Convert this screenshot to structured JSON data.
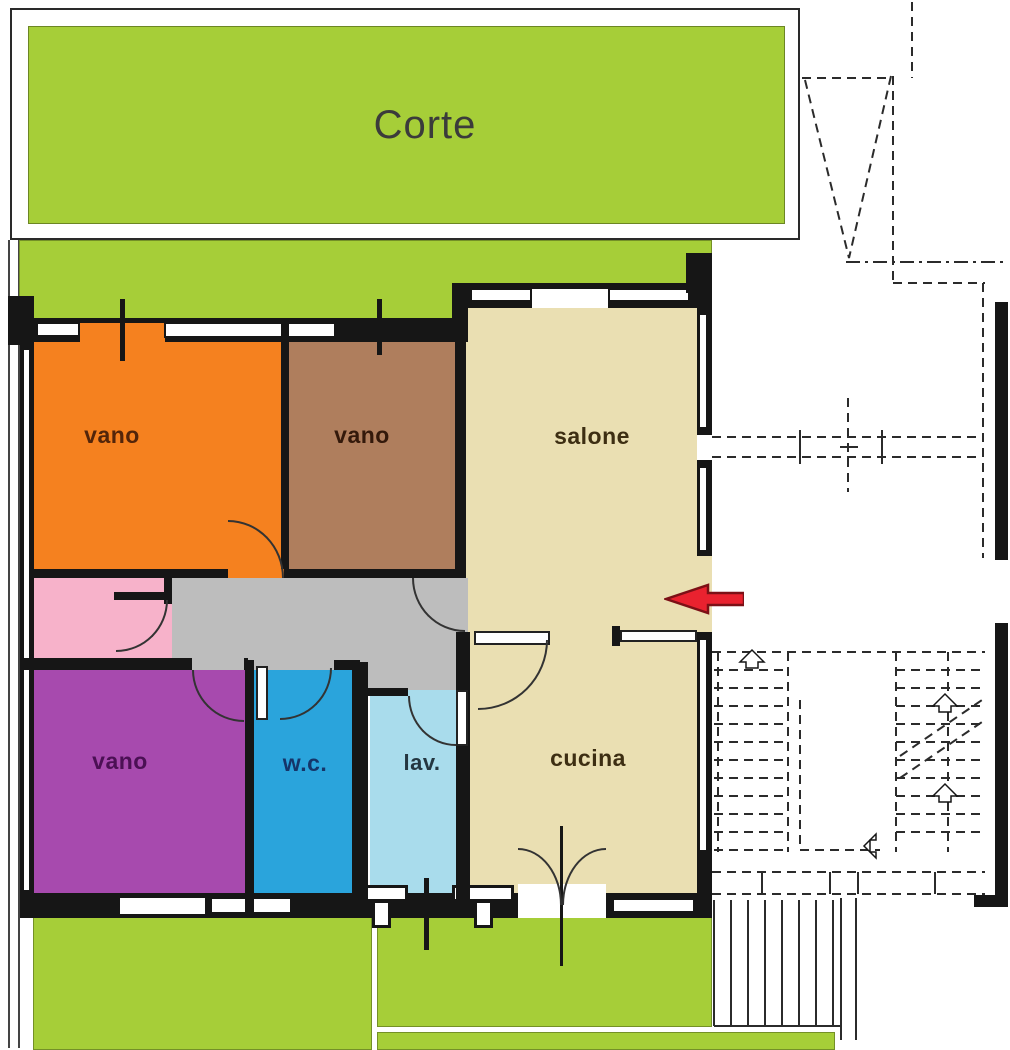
{
  "floorplan": {
    "court": {
      "label": "Corte",
      "color": "#A6CE38",
      "text_color": "#3b3b3b"
    },
    "garden_color": "#A6CE38",
    "wall_color": "#161616",
    "rooms": [
      {
        "id": "vano-nw",
        "label": "vano",
        "color": "#F5811F",
        "text_color": "#53250a"
      },
      {
        "id": "vano-n",
        "label": "vano",
        "color": "#AF7E5D",
        "text_color": "#33190b"
      },
      {
        "id": "salone",
        "label": "salone",
        "color": "#EADFB2",
        "text_color": "#3d2e12"
      },
      {
        "id": "disimpegno",
        "color": "#BDBDBD"
      },
      {
        "id": "ripostiglio",
        "color": "#F7B2CA"
      },
      {
        "id": "vano-sw",
        "label": "vano",
        "color": "#A74AAE",
        "text_color": "#4b1054"
      },
      {
        "id": "wc",
        "label": "w.c.",
        "color": "#2AA4DC",
        "text_color": "#153569"
      },
      {
        "id": "lav",
        "label": "lav.",
        "color": "#A9DCEC",
        "text_color": "#243640"
      },
      {
        "id": "cucina",
        "label": "cucina",
        "color": "#EADFB2",
        "text_color": "#3d2e12"
      }
    ],
    "entrance_arrow": {
      "fill": "#E9222F",
      "stroke": "#7c1016"
    }
  }
}
